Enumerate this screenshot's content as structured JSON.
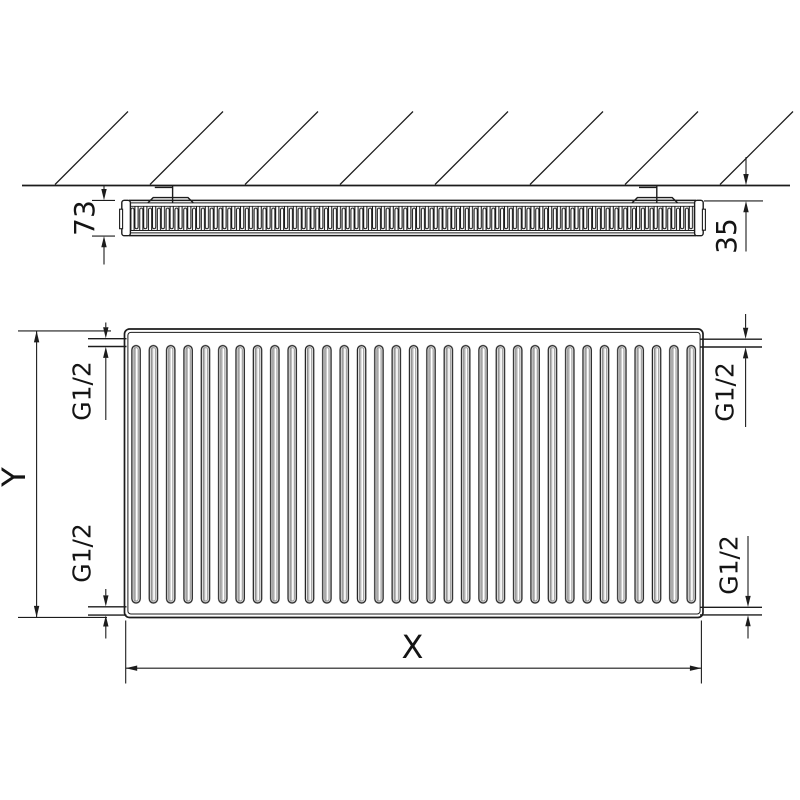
{
  "drawing": {
    "top_view": {
      "depth_dimension": "73",
      "wall_distance_dimension": "35"
    },
    "front_view": {
      "height_dimension": "Y",
      "width_dimension": "X",
      "connections": {
        "top_left": "G1/2",
        "bottom_left": "G1/2",
        "top_right": "G1/2",
        "bottom_right": "G1/2"
      }
    }
  }
}
